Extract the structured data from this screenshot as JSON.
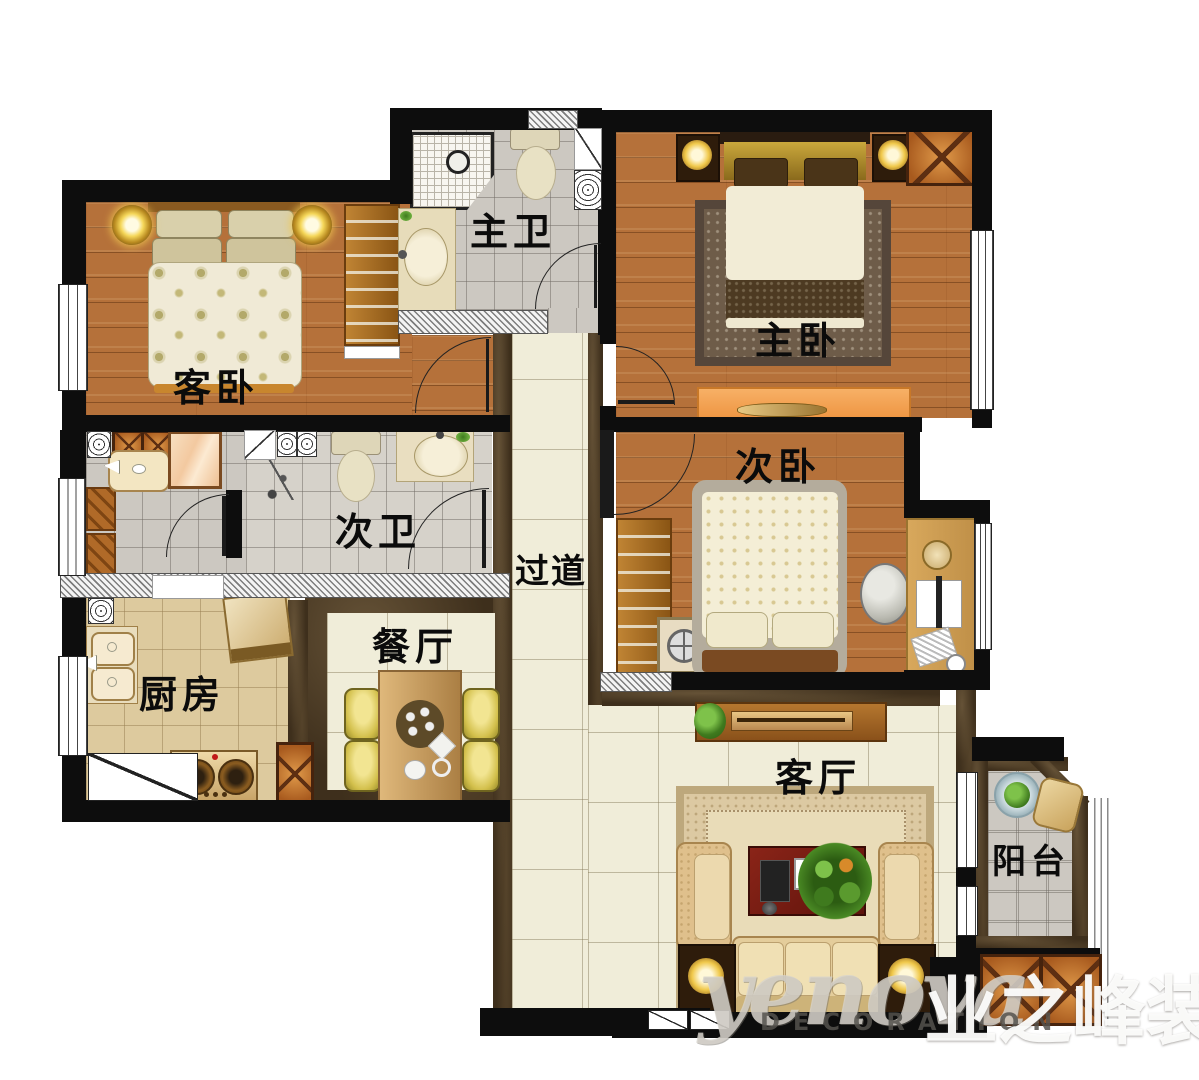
{
  "rooms": {
    "guest_bedroom": {
      "label": "客卧",
      "furniture": [
        "double-bed",
        "bedside-lamp",
        "bedside-lamp",
        "wardrobe"
      ]
    },
    "master_bathroom": {
      "label": "主卫",
      "furniture": [
        "shower-enclosure",
        "toilet",
        "wash-basin",
        "water-heater"
      ]
    },
    "master_bedroom": {
      "label": "主卧",
      "furniture": [
        "double-bed",
        "rug",
        "bedside-lamp",
        "bedside-lamp",
        "wardrobe-column",
        "dresser"
      ]
    },
    "second_bathroom": {
      "label": "次卫",
      "furniture": [
        "toilet",
        "wash-basin",
        "shower-head",
        "mirror",
        "cabinet",
        "laundry-sink"
      ]
    },
    "second_bedroom": {
      "label": "次卧",
      "furniture": [
        "double-bed",
        "wardrobe",
        "washing-machine",
        "desk",
        "monitor",
        "chair"
      ]
    },
    "hallway": {
      "label": "过道",
      "furniture": []
    },
    "kitchen": {
      "label": "厨房",
      "furniture": [
        "double-sink",
        "gas-stove",
        "range-hood"
      ]
    },
    "dining_room": {
      "label": "餐厅",
      "furniture": [
        "dining-table",
        "chair",
        "chair",
        "chair",
        "chair"
      ]
    },
    "living_room": {
      "label": "客厅",
      "furniture": [
        "tv-cabinet",
        "sofa",
        "armchair",
        "armchair",
        "coffee-table",
        "plant",
        "rug",
        "side-lamp-table",
        "side-lamp-table"
      ]
    },
    "balcony": {
      "label": "阳台",
      "furniture": [
        "plant-table",
        "chair"
      ]
    }
  },
  "watermark": {
    "brand": "yenova",
    "tagline": "DECORATION",
    "cn_brand": "业之峰装"
  },
  "palette": {
    "wall": "#0d0d0d",
    "wood_floor": "#b5713a",
    "gray_tile": "#ccc8c1",
    "cream_tile": "#f0edd9",
    "kitchen_tile": "#ddca9e",
    "marble_border": "#3e2f1c",
    "dresser_orange": "#f2a259",
    "sofa_tan": "#e0c896",
    "coffee_table_red": "#7e2014"
  }
}
